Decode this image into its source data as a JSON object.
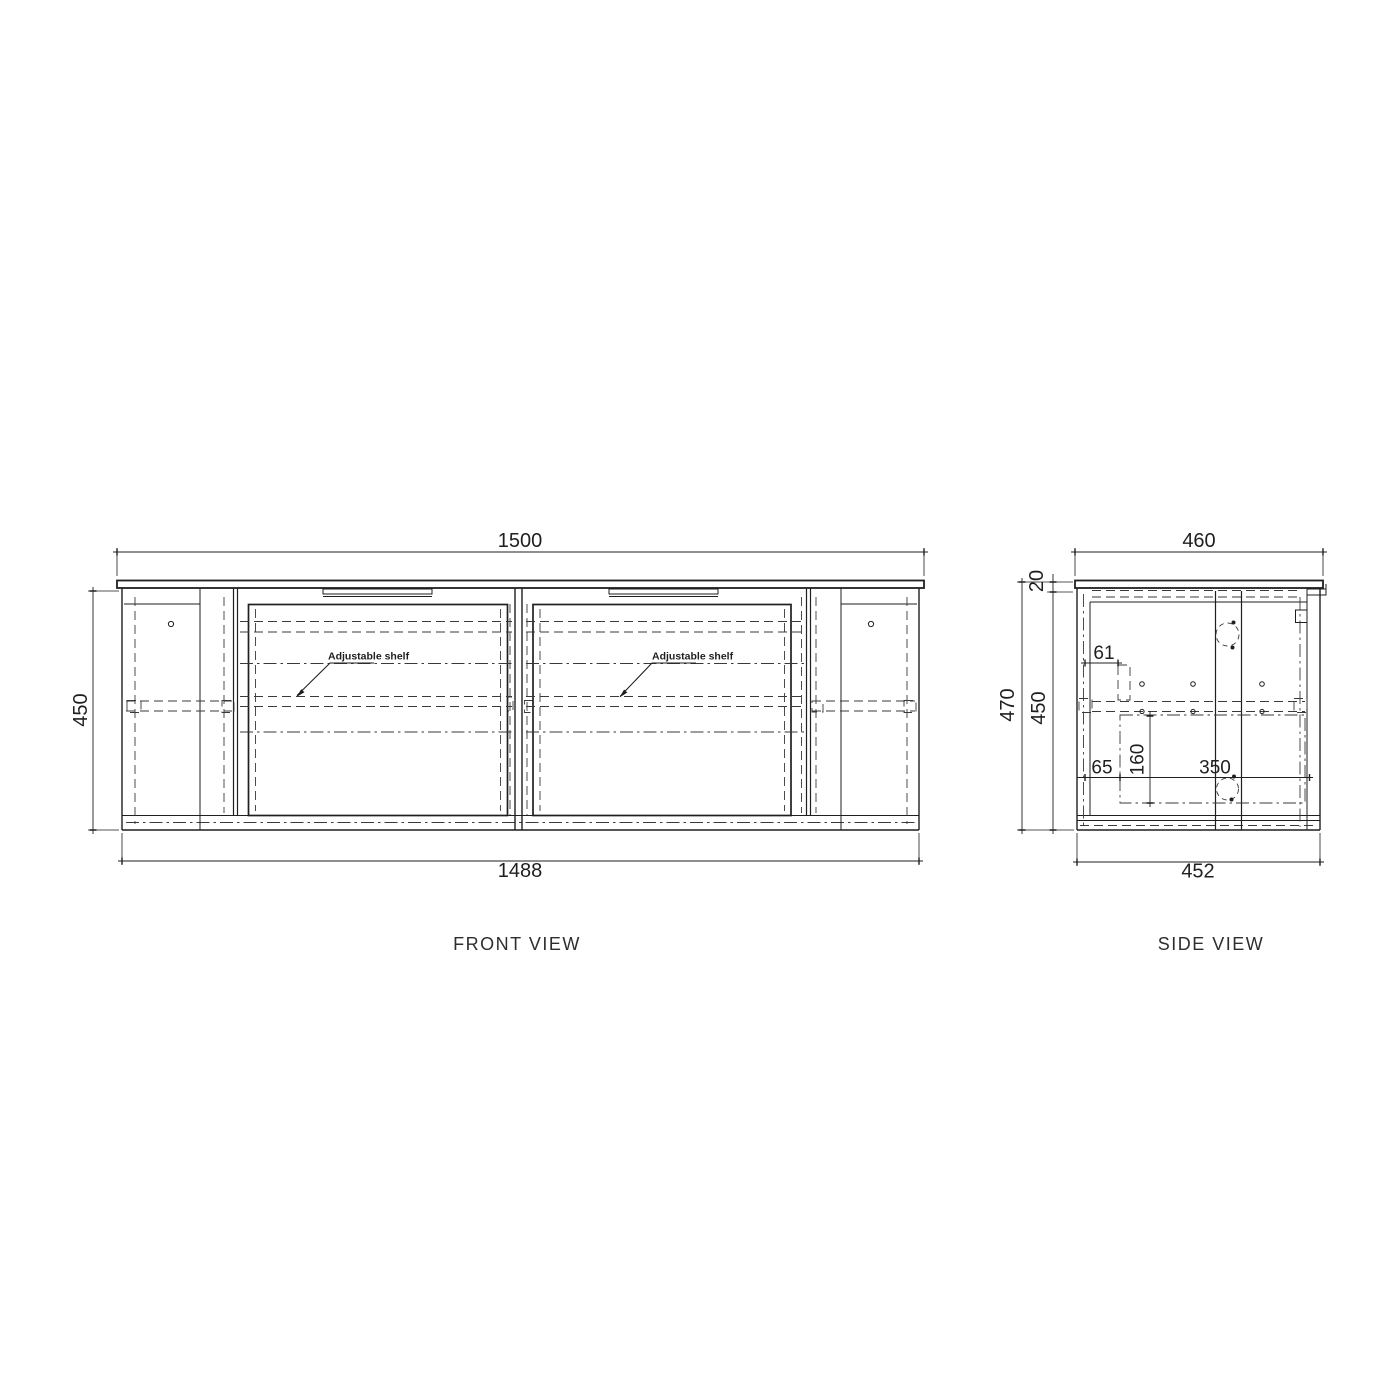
{
  "front": {
    "title": "FRONT VIEW",
    "dim_top": "1500",
    "dim_bottom": "1488",
    "dim_height": "450",
    "shelf_note_left": "Adjustable shelf",
    "shelf_note_right": "Adjustable shelf"
  },
  "side": {
    "title": "SIDE VIEW",
    "dim_top": "460",
    "dim_bottom": "452",
    "dim_height_overall": "470",
    "dim_height_carcass": "450",
    "dim_countertop_thickness": "20",
    "dim_shelf_bracket_offset": "61",
    "dim_drawer_offset": "65",
    "dim_drawer_height": "160",
    "dim_drawer_depth": "350"
  },
  "colors": {
    "line": "#1f1f1f",
    "background": "#ffffff",
    "label": "#2e2e2e"
  }
}
